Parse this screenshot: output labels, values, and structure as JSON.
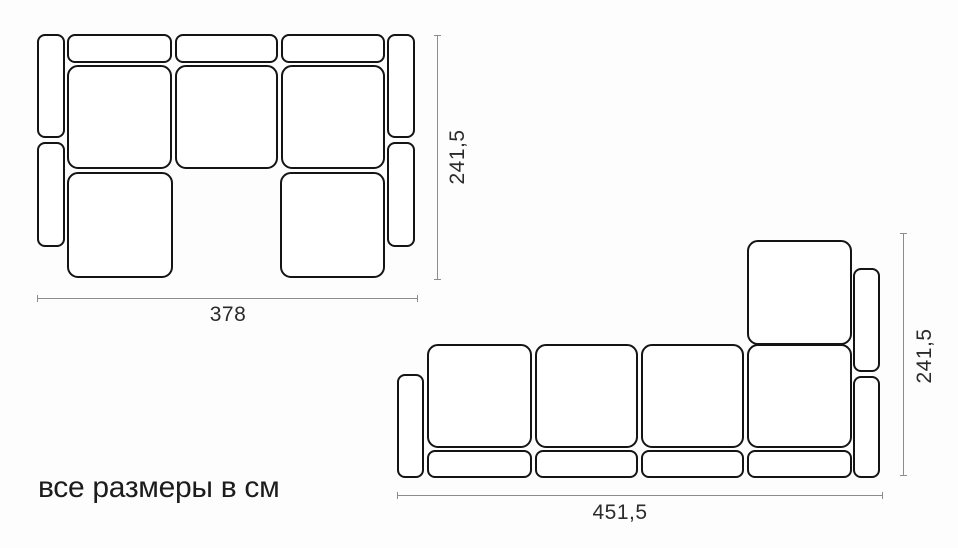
{
  "caption": "все размеры в см",
  "colors": {
    "outline": "#141414",
    "dimension_line": "#8c8c8c",
    "label": "#2b2b2b",
    "background": "#fdfdfd"
  },
  "units": "см",
  "diagrams": [
    {
      "id": "sofa-u-shaped",
      "description": "U-shaped sectional sofa, top view",
      "width_label": "378",
      "height_label": "241,5",
      "modules": [
        {
          "name": "armrest-left-top",
          "x": 37,
          "y": 34,
          "w": 28,
          "h": 104
        },
        {
          "name": "armrest-left-bottom",
          "x": 37,
          "y": 142,
          "w": 28,
          "h": 105
        },
        {
          "name": "back-cushion-1",
          "x": 67,
          "y": 34,
          "w": 105,
          "h": 29
        },
        {
          "name": "back-cushion-2",
          "x": 175,
          "y": 34,
          "w": 103,
          "h": 29
        },
        {
          "name": "back-cushion-3",
          "x": 281,
          "y": 34,
          "w": 104,
          "h": 29
        },
        {
          "name": "seat-1",
          "x": 67,
          "y": 65,
          "w": 105,
          "h": 104
        },
        {
          "name": "seat-2",
          "x": 175,
          "y": 65,
          "w": 103,
          "h": 104
        },
        {
          "name": "seat-3",
          "x": 281,
          "y": 65,
          "w": 104,
          "h": 104
        },
        {
          "name": "chaise-left",
          "x": 67,
          "y": 172,
          "w": 106,
          "h": 106
        },
        {
          "name": "chaise-right",
          "x": 280,
          "y": 172,
          "w": 105,
          "h": 106
        },
        {
          "name": "armrest-right-top",
          "x": 387,
          "y": 34,
          "w": 28,
          "h": 104
        },
        {
          "name": "armrest-right-bottom",
          "x": 387,
          "y": 142,
          "w": 28,
          "h": 105
        }
      ]
    },
    {
      "id": "sofa-l-shaped",
      "description": "L-shaped sectional sofa with corner chaise, top view",
      "width_label": "451,5",
      "height_label": "241,5",
      "modules": [
        {
          "name": "armrest-left",
          "x": 397,
          "y": 374,
          "w": 27,
          "h": 104
        },
        {
          "name": "chaise",
          "x": 747,
          "y": 240,
          "w": 105,
          "h": 105
        },
        {
          "name": "seat-1",
          "x": 427,
          "y": 344,
          "w": 105,
          "h": 104
        },
        {
          "name": "seat-2",
          "x": 535,
          "y": 344,
          "w": 103,
          "h": 104
        },
        {
          "name": "seat-3",
          "x": 641,
          "y": 344,
          "w": 103,
          "h": 104
        },
        {
          "name": "seat-4-corner",
          "x": 747,
          "y": 344,
          "w": 105,
          "h": 104
        },
        {
          "name": "armrest-right-top",
          "x": 853,
          "y": 268,
          "w": 27,
          "h": 104
        },
        {
          "name": "armrest-right-bottom",
          "x": 853,
          "y": 376,
          "w": 27,
          "h": 102
        },
        {
          "name": "back-cushion-1",
          "x": 427,
          "y": 450,
          "w": 105,
          "h": 28
        },
        {
          "name": "back-cushion-2",
          "x": 535,
          "y": 450,
          "w": 103,
          "h": 28
        },
        {
          "name": "back-cushion-3",
          "x": 641,
          "y": 450,
          "w": 103,
          "h": 28
        },
        {
          "name": "back-cushion-4",
          "x": 747,
          "y": 450,
          "w": 105,
          "h": 28
        }
      ]
    }
  ]
}
